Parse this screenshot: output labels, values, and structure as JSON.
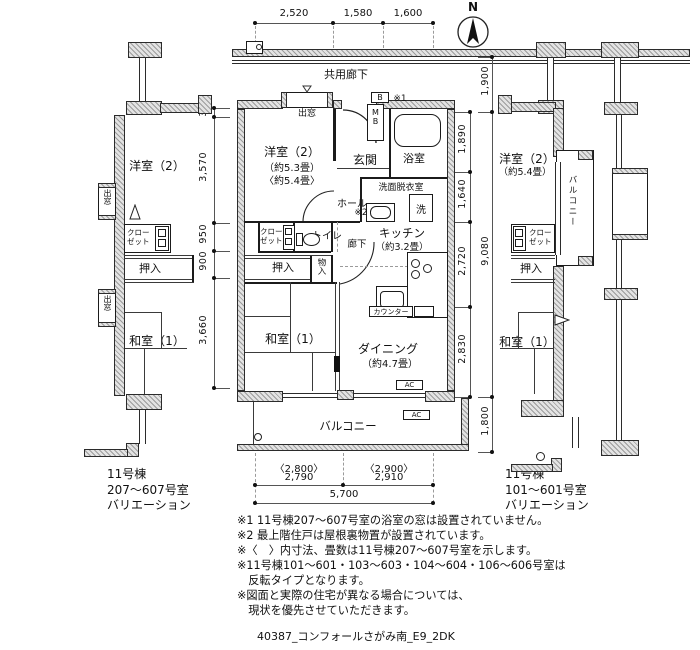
{
  "header": {
    "compass_label": "N",
    "corridor_label": "共用廊下"
  },
  "dimensions": {
    "top": [
      "2,520",
      "1,580",
      "1,600"
    ],
    "left": [
      "305",
      "3,570",
      "950",
      "900",
      "3,660"
    ],
    "right_inner": [
      "1,890",
      "1,640",
      "2,720",
      "2,830"
    ],
    "right_outer": [
      "1,900",
      "9,080",
      "1,800"
    ],
    "bottom_paren": [
      "〈2,800〉",
      "〈2,900〉"
    ],
    "bottom_values": [
      "2,790",
      "2,910"
    ],
    "bottom_total": "5,700"
  },
  "unit": {
    "bay_window": "出窓",
    "western_room": "洋室（2）",
    "western_room_area1": "（約5.3畳）",
    "western_room_area2": "〈約5.4畳〉",
    "entrance": "玄関",
    "box_b": "B",
    "meter_box": "MB",
    "note_ref_1": "※1",
    "bath": "浴室",
    "washroom": "洗面脱衣室",
    "laundry": "洗",
    "hall": "ホール",
    "note_ref_2": "※2",
    "toilet": "トイレ",
    "closet_l1": "クロー",
    "closet_l2": "ゼット",
    "corridor": "廊下",
    "kitchen": "キッチン",
    "kitchen_area": "（約3.2畳）",
    "counter": "カウンター",
    "oshiire": "押入",
    "storage": "物入",
    "japanese_room": "和室（1）",
    "dining": "ダイニング",
    "dining_area": "（約4.7畳）",
    "balcony": "バルコニー",
    "ac1": "AC",
    "ac2": "AC"
  },
  "left_wing": {
    "western_room": "洋室（2）",
    "bay_window_1": "出窓",
    "closet_l1": "クロー",
    "closet_l2": "ゼット",
    "oshiire": "押入",
    "bay_window_2": "出窓",
    "japanese_room": "和室（1）"
  },
  "right_wing": {
    "western_room": "洋室（2）",
    "western_room_area": "（約5.4畳）",
    "balcony": "バルコニー",
    "closet_l1": "クロー",
    "closet_l2": "ゼット",
    "oshiire": "押入",
    "japanese_room": "和室（1）"
  },
  "captions": {
    "left": [
      "11号棟",
      "207～607号室",
      "バリエーション"
    ],
    "right": [
      "11号棟",
      "101～601号室",
      "バリエーション"
    ]
  },
  "notes": [
    "※1 11号棟207～607号室の浴室の窓は設置されていません。",
    "※2 最上階住戸は屋根裏物置が設置されています。",
    "※〈　〉内寸法、畳数は11号棟207～607号室を示します。",
    "※11号棟101～601・103～603・104～604・106～606号室は",
    "　反転タイプとなります。",
    "※図面と実際の住宅が異なる場合については、",
    "　現状を優先させていただきます。"
  ],
  "footer": "40387_コンフォールさがみ南_E9_2DK"
}
